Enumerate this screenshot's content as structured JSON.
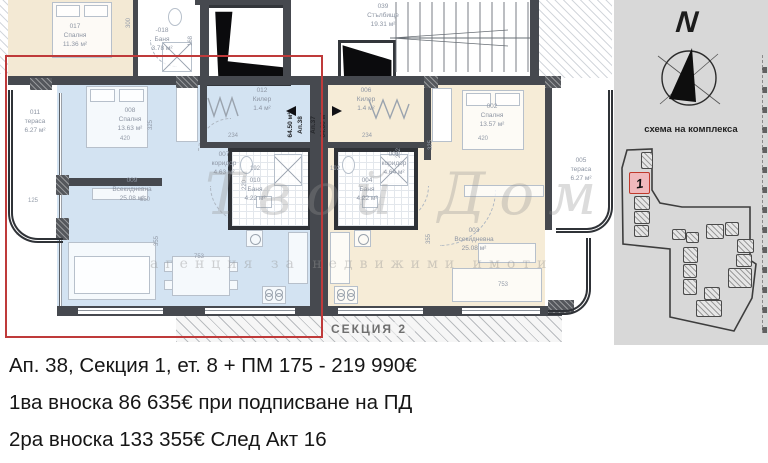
{
  "listing": {
    "line1": "Ап. 38, Секция 1, ет. 8 + ПМ 175 - 219 990€",
    "line2": "1ва вноска 86 635€ при подписване на ПД",
    "line3": "2ра вноска 133 355€ След Акт 16"
  },
  "plan": {
    "section_label": "СЕКЦИЯ 2",
    "apartments": {
      "apt38": {
        "id": "Ап.38",
        "area": "64.50 м²"
      },
      "apt37": {
        "id": "Ап.37",
        "area": "64.60 м²"
      }
    },
    "rooms": {
      "r001": {
        "num": "001",
        "name": "коридор",
        "area": "4.64 м²"
      },
      "r002": {
        "num": "002",
        "name": "Спалня",
        "area": "13.57 м²"
      },
      "r003": {
        "num": "003",
        "name": "Всекидневна",
        "area": "25.08 м²"
      },
      "r004": {
        "num": "004",
        "name": "Баня",
        "area": "4.22 м²"
      },
      "r005": {
        "num": "005",
        "name": "тераса",
        "area": "6.27 м²"
      },
      "r006": {
        "num": "006",
        "name": "Килер",
        "area": "1.4 м²"
      },
      "r007": {
        "num": "007",
        "name": "коридор",
        "area": "4.63 м²"
      },
      "r008": {
        "num": "008",
        "name": "Спалня",
        "area": "13.63 м²"
      },
      "r009": {
        "num": "009",
        "name": "Всекидневна",
        "area": "25.08 м²"
      },
      "r010": {
        "num": "010",
        "name": "Баня",
        "area": "4.22 м²"
      },
      "r011": {
        "num": "011",
        "name": "тераса",
        "area": "6.27 м²"
      },
      "r012": {
        "num": "012",
        "name": "Килер",
        "area": "1.4 м²"
      },
      "r017": {
        "num": "017",
        "name": "Спалня",
        "area": "11.36 м²"
      },
      "r018": {
        "num": "-018",
        "name": "Баня",
        "area": "3.78 м²"
      },
      "r039": {
        "num": "039",
        "name": "Стълбище",
        "area": "19.31 м²"
      }
    },
    "dims": {
      "d125": "125",
      "d168": "168",
      "d192": "192",
      "d220": "220",
      "d234": "234",
      "d262": "262",
      "d300": "300",
      "d325": "325",
      "d355": "355",
      "d420": "420",
      "d550": "550",
      "d753": "753"
    },
    "watermark": {
      "brand": "Твой Дом",
      "agency": "агенция за недвижими имоти"
    }
  },
  "site": {
    "compass_label": "N",
    "title": "схема на комплекса",
    "highlighted_building": "1"
  },
  "colors": {
    "apartment_left": "#d3e3f2",
    "apartment_right": "#f6ecd7",
    "room_beige": "#f3e9d4",
    "wall": "#46494f",
    "annotation_red": "#bf3a3a",
    "panel_bg": "#d8d8d8",
    "highlight_pink": "#f0b9bc"
  }
}
